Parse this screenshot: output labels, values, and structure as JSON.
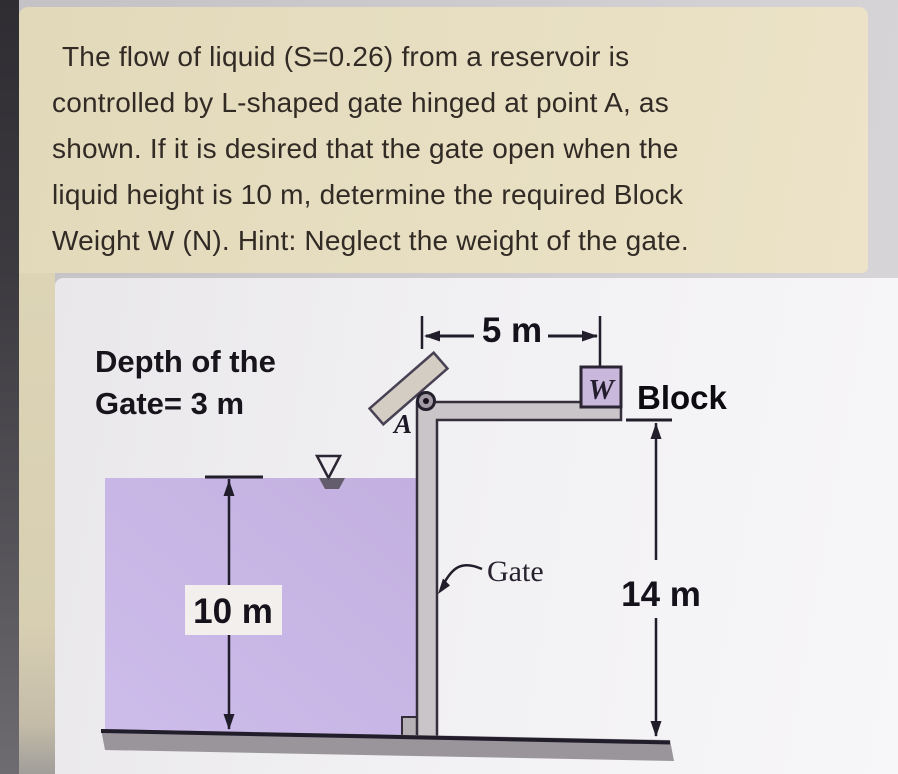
{
  "problem": {
    "lines": [
      "The flow of liquid (S=0.26) from a reservoir is",
      "controlled by L-shaped gate hinged at point A, as",
      "shown. If it is desired that the gate open when the",
      "liquid height is 10 m, determine the required Block",
      "Weight W (N). Hint: Neglect the weight of the gate."
    ]
  },
  "diagram": {
    "depth_note_line1": "Depth of the",
    "depth_note_line2": "Gate= 3 m",
    "top_width_dim": "5 m",
    "liquid_height_dim": "10 m",
    "right_height_dim": "14 m",
    "hinge_label": "A",
    "weight_symbol": "W",
    "block_label": "Block",
    "gate_label": "Gate"
  },
  "colors": {
    "card_bg": "#e7dec1",
    "liquid": "#c7b5e5",
    "gate_gray": "#cac5c8",
    "ground_gray": "#9a959b",
    "block_fill": "#c9b7dc",
    "bracket_fill": "#d4cdc3"
  }
}
